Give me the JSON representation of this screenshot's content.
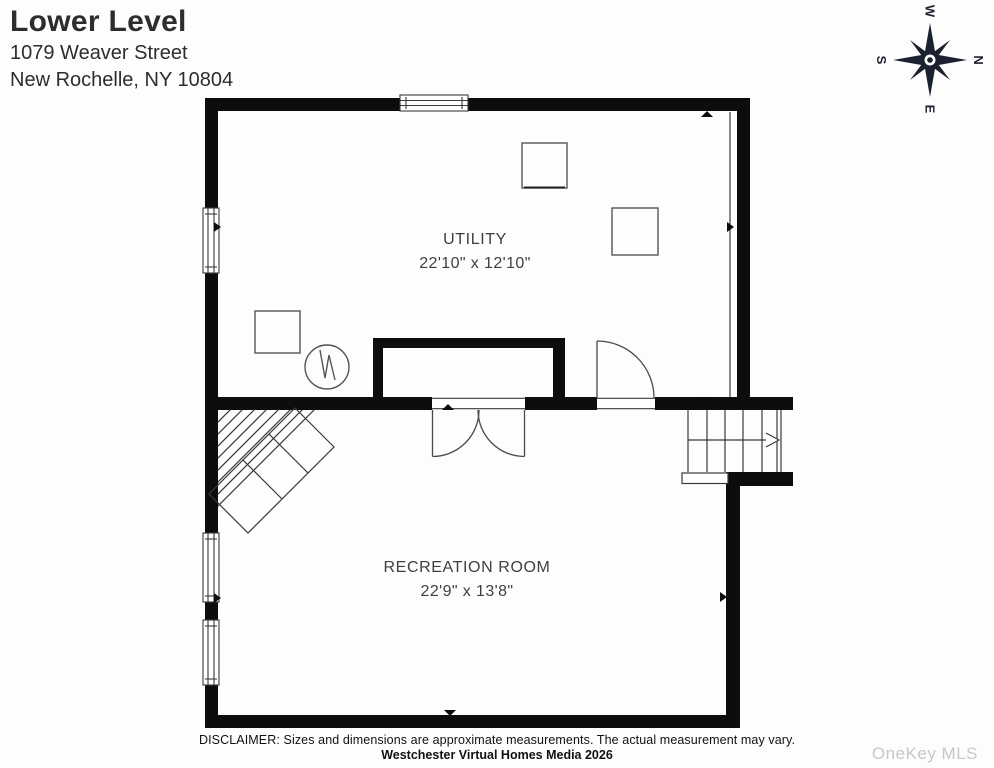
{
  "header": {
    "title": "Lower Level",
    "address_line1": "1079 Weaver Street",
    "address_line2": "New Rochelle, NY 10804"
  },
  "compass": {
    "n": "N",
    "e": "E",
    "s": "S",
    "w": "W"
  },
  "rooms": [
    {
      "name": "UTILITY",
      "dimensions": "22'10\" x 12'10\""
    },
    {
      "name": "RECREATION ROOM",
      "dimensions": "22'9\" x 13'8\""
    }
  ],
  "footer": {
    "disclaimer": "DISCLAIMER: Sizes and dimensions are approximate measurements. The actual measurement may vary.",
    "credit": "Westchester Virtual Homes Media 2026",
    "watermark": "OneKey MLS"
  },
  "colors": {
    "wall": "#0d0d0d",
    "thin_line": "#3a3a3a",
    "furniture_line": "#555555",
    "compass": "#1c2130",
    "watermark_gray": "#c7c7c7"
  }
}
